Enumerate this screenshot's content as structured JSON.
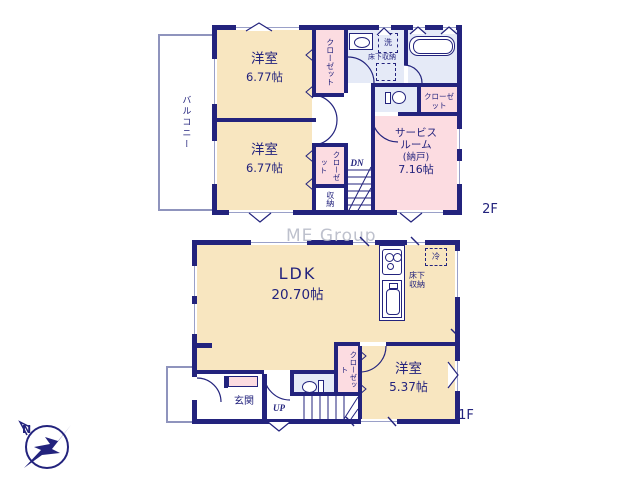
{
  "colors": {
    "wall": "#23237d",
    "room_cream": "#f8e6c0",
    "room_pink": "#fcdce1",
    "room_blue": "#e5eaf7",
    "watermark": "#b7bbc8"
  },
  "watermark_text": "ME Group",
  "compass": {
    "north_label": "N"
  },
  "floor2": {
    "floor_label": "2F",
    "balcony_label": "バルコニー",
    "bedroom1_name": "洋室",
    "bedroom1_size": "6.77帖",
    "bedroom2_name": "洋室",
    "bedroom2_size": "6.77帖",
    "closet_top_label": "クローゼット",
    "closet_mid_label": "クローゼット",
    "storage_label": "収納",
    "closet_right_label": "クローゼット",
    "service_room": {
      "line1": "サービス",
      "line2": "ルーム",
      "line3": "(納戸)",
      "line4": "7.16帖"
    },
    "laundry_label": "洗",
    "underfloor_label": "床下収納",
    "stairs_down_label": "DN"
  },
  "floor1": {
    "floor_label": "1F",
    "ldk_name": "LDK",
    "ldk_size": "20.70帖",
    "bedroom_name": "洋室",
    "bedroom_size": "5.37帖",
    "closet_label": "クローゼット",
    "entrance_label": "玄関",
    "stairs_up_label": "UP",
    "fridge_label": "冷",
    "underfloor_line1": "床下",
    "underfloor_line2": "収納"
  }
}
